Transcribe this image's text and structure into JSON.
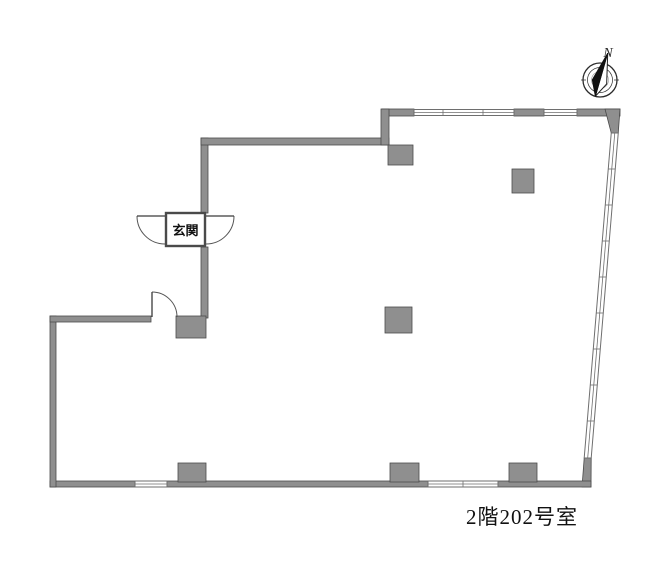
{
  "title": {
    "text": "2階202号室"
  },
  "entrance": {
    "label": "玄関"
  },
  "compass": {
    "label": "N"
  },
  "colors": {
    "page_bg": "#ffffff",
    "wall_fill": "#8f8f8f",
    "wall_edge": "#4a4a4a",
    "window_line": "#6e6e6e",
    "door_line": "#555555",
    "compass_ink": "#2b2b2b",
    "text_ink": "#111111"
  }
}
